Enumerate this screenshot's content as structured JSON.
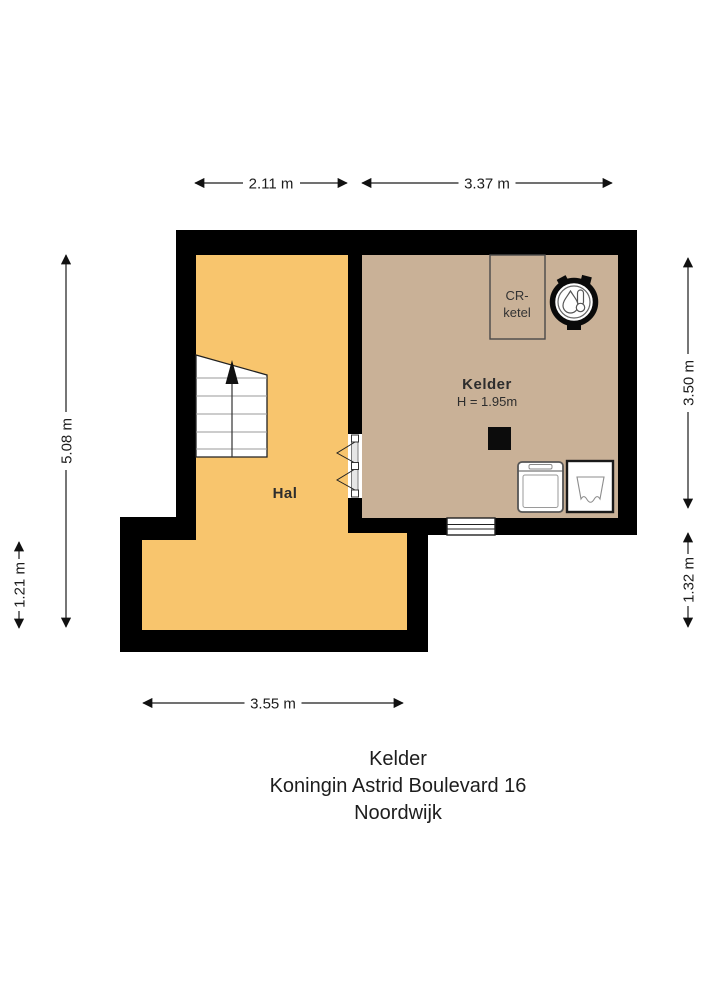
{
  "plan": {
    "rooms": {
      "hal": {
        "label": "Hal"
      },
      "kelder": {
        "label": "Kelder",
        "height": "H = 1.95m"
      }
    },
    "fixtures": {
      "boiler_box": {
        "line1": "CR-",
        "line2": "ketel"
      }
    },
    "dimensions": {
      "top_left": "2.11 m",
      "top_right": "3.37 m",
      "left_upper": "5.08 m",
      "left_lower": "1.21 m",
      "right_upper": "3.50 m",
      "right_lower": "1.32 m",
      "bottom": "3.55 m"
    }
  },
  "title_block": {
    "floor": "Kelder",
    "address": "Koningin Astrid Boulevard 16",
    "city": "Noordwijk"
  },
  "colors": {
    "wall": "#000000",
    "hal_floor": "#f8c56d",
    "kelder_floor": "#c9b197",
    "stair_fill": "#ffffff",
    "dim_text": "#1c1c1c"
  }
}
